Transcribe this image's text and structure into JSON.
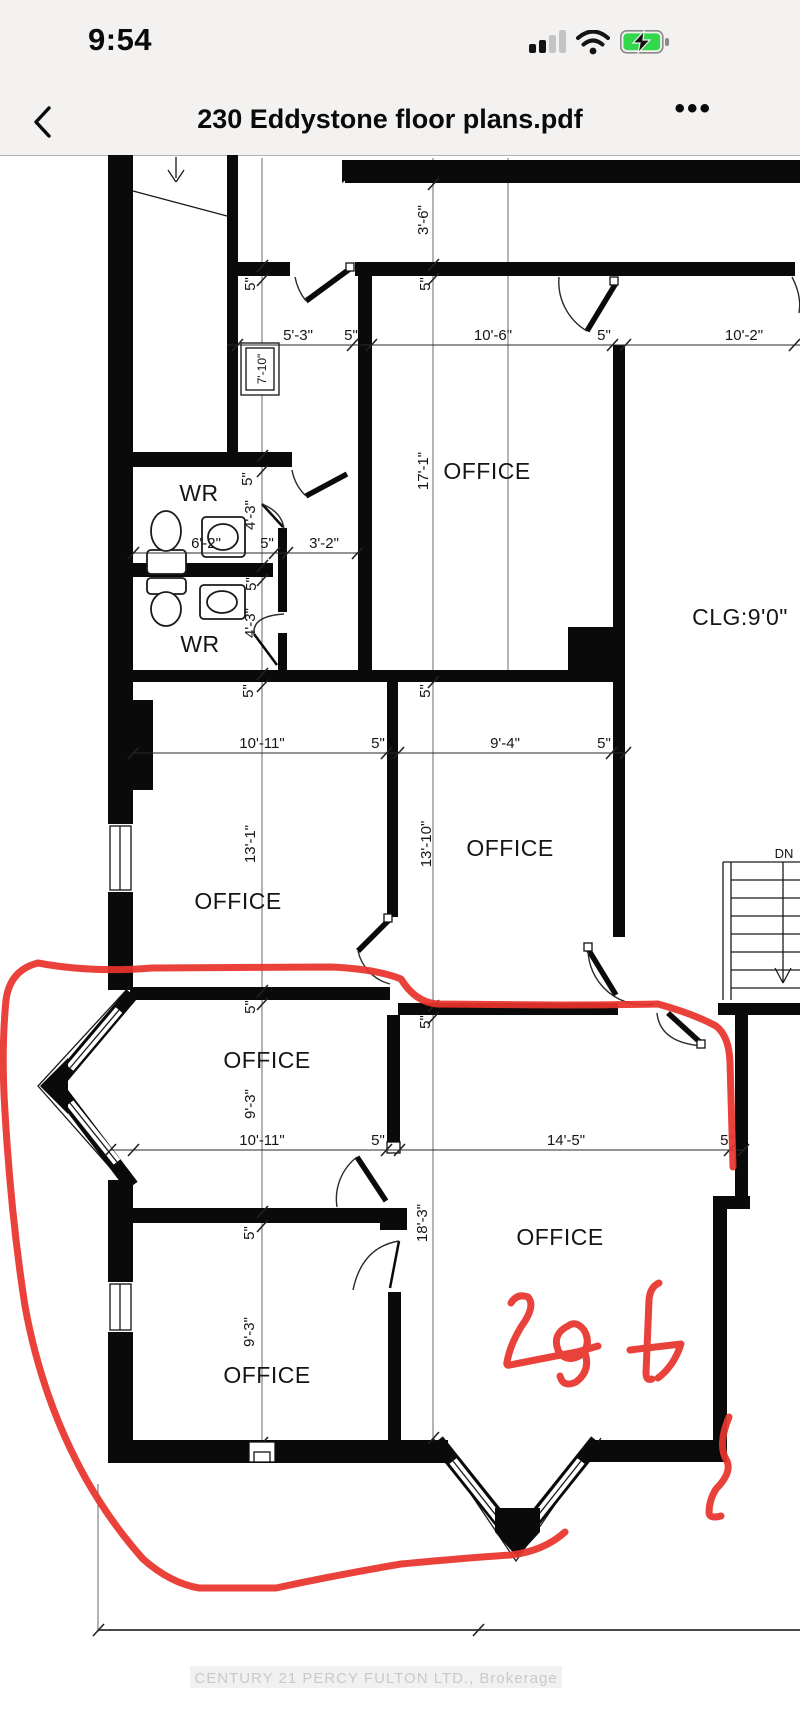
{
  "status_bar": {
    "time": "9:54"
  },
  "nav_bar": {
    "title": "230 Eddystone floor plans.pdf",
    "more_label": "•••"
  },
  "plan": {
    "rooms": {
      "office": "OFFICE",
      "wr": "WR",
      "ceiling": "CLG:9'0\"",
      "stairs_down": "DN"
    },
    "dims": {
      "five": "5\"",
      "d5_3": "5'-3\"",
      "d10_6": "10'-6\"",
      "d10_2": "10'-2\"",
      "d3_6": "3'-6\"",
      "d17_1": "17'-1\"",
      "d6_2": "6'-2\"",
      "d3_2": "3'-2\"",
      "d7_10": "7'-10\"",
      "d4_3": "4'-3\"",
      "d10_11": "10'-11\"",
      "d9_4": "9'-4\"",
      "d13_1": "13'-1\"",
      "d13_10": "13'-10\"",
      "d9_3": "9'-3\"",
      "d14_5": "14'-5\"",
      "d18_3": "18'-3\""
    },
    "annotation": {
      "transcription": "2o f",
      "color": "#e8342c"
    },
    "watermark": "CENTURY 21 PERCY FULTON LTD., Brokerage"
  }
}
